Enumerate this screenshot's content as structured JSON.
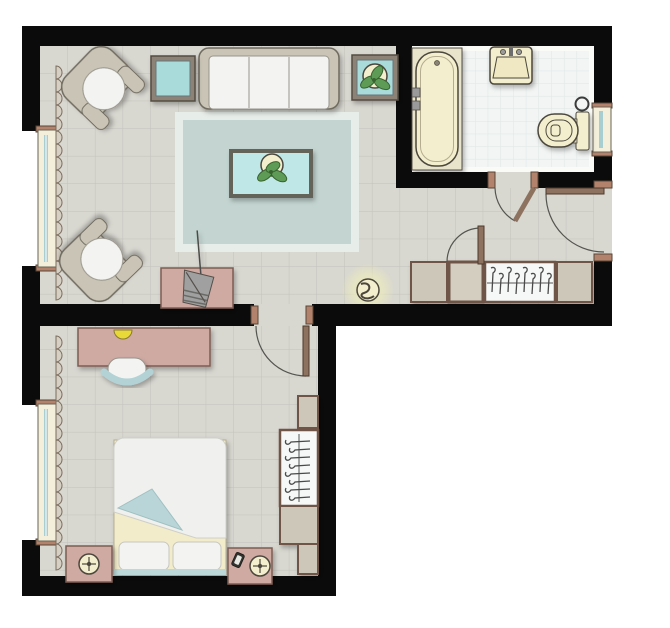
{
  "title": "apartment-floor-plan",
  "colors": {
    "outside": "#ffffff",
    "wall": "#0b0b0b",
    "floor": "#d8d7d0",
    "floor_grid": "#c2c2ba",
    "bath_floor": "#f2f5f4",
    "bath_grid": "#dfe6e5",
    "bath_border": "#fafaf7",
    "rug_border": "#e7ede9",
    "rug": "#c4d5d1",
    "glass_table": "#bfe7e7",
    "table_teal_top": "#a9dbdb",
    "table_frame": "#8c8376",
    "coffee_frame": "#63635a",
    "sofa_frame": "#c9c4b5",
    "sofa_outline": "#6f6b5f",
    "cushion": "#f3f3f1",
    "cushion_outline": "#97948a",
    "pink": "#cfaaa3",
    "pink_outline": "#7d5d53",
    "cream": "#f3eecd",
    "cream_outline": "#4c473c",
    "platform": "#e8e3cb",
    "tan": "#cdc7b9",
    "tan_light": "#d4cec0",
    "wood_brown": "#6e5546",
    "door_leaf": "#8d7260",
    "door_arc": "#555550",
    "jamb_sienna": "#b3826c",
    "window_cream": "#f3efdb",
    "window_glass": "#a9ced2",
    "window_outline": "#6b6355",
    "leaf_green": "#5d9b57",
    "leaf_outline": "#39632f",
    "lamp_glow": "#eeedbb",
    "lamp_yellow": "#e8d839",
    "chair_back_teal": "#b2d2d6",
    "bed_fold_teal": "#b9d5d7",
    "bed_strip_teal": "#bcd8d8",
    "sheet_cream": "#f2ecca",
    "sheet_outline": "#b5ae95",
    "duvet": "#f0f0ee",
    "duvet_outline": "#cfcfc9",
    "white_unit": "#f6f8f7",
    "basket_gray": "#a0a0a0",
    "hanger_gray": "#4a4a4a",
    "fixture_gray": "#9a9a9a"
  },
  "plan": {
    "rooms": [
      {
        "name": "living-room",
        "furniture": [
          "sofa-three-seat",
          "armchair",
          "armchair",
          "side-table",
          "side-table-with-plant",
          "area-rug",
          "coffee-table-with-plant",
          "console-table",
          "magazine-basket",
          "floor-lamp",
          "window",
          "curtain"
        ]
      },
      {
        "name": "bathroom",
        "furniture": [
          "bathtub",
          "wash-basin",
          "toilet",
          "towel-ring",
          "window",
          "door"
        ]
      },
      {
        "name": "hallway",
        "furniture": [
          "wardrobe-with-hangers",
          "closet-door",
          "entry-door",
          "lamp"
        ]
      },
      {
        "name": "bedroom",
        "furniture": [
          "double-bed",
          "pillow",
          "pillow",
          "nightstand-left",
          "nightstand-right",
          "table-lamp",
          "table-lamp",
          "phone",
          "desk",
          "desk-lamp",
          "chair",
          "wardrobe-with-hangers",
          "window",
          "curtain",
          "door"
        ]
      }
    ]
  }
}
